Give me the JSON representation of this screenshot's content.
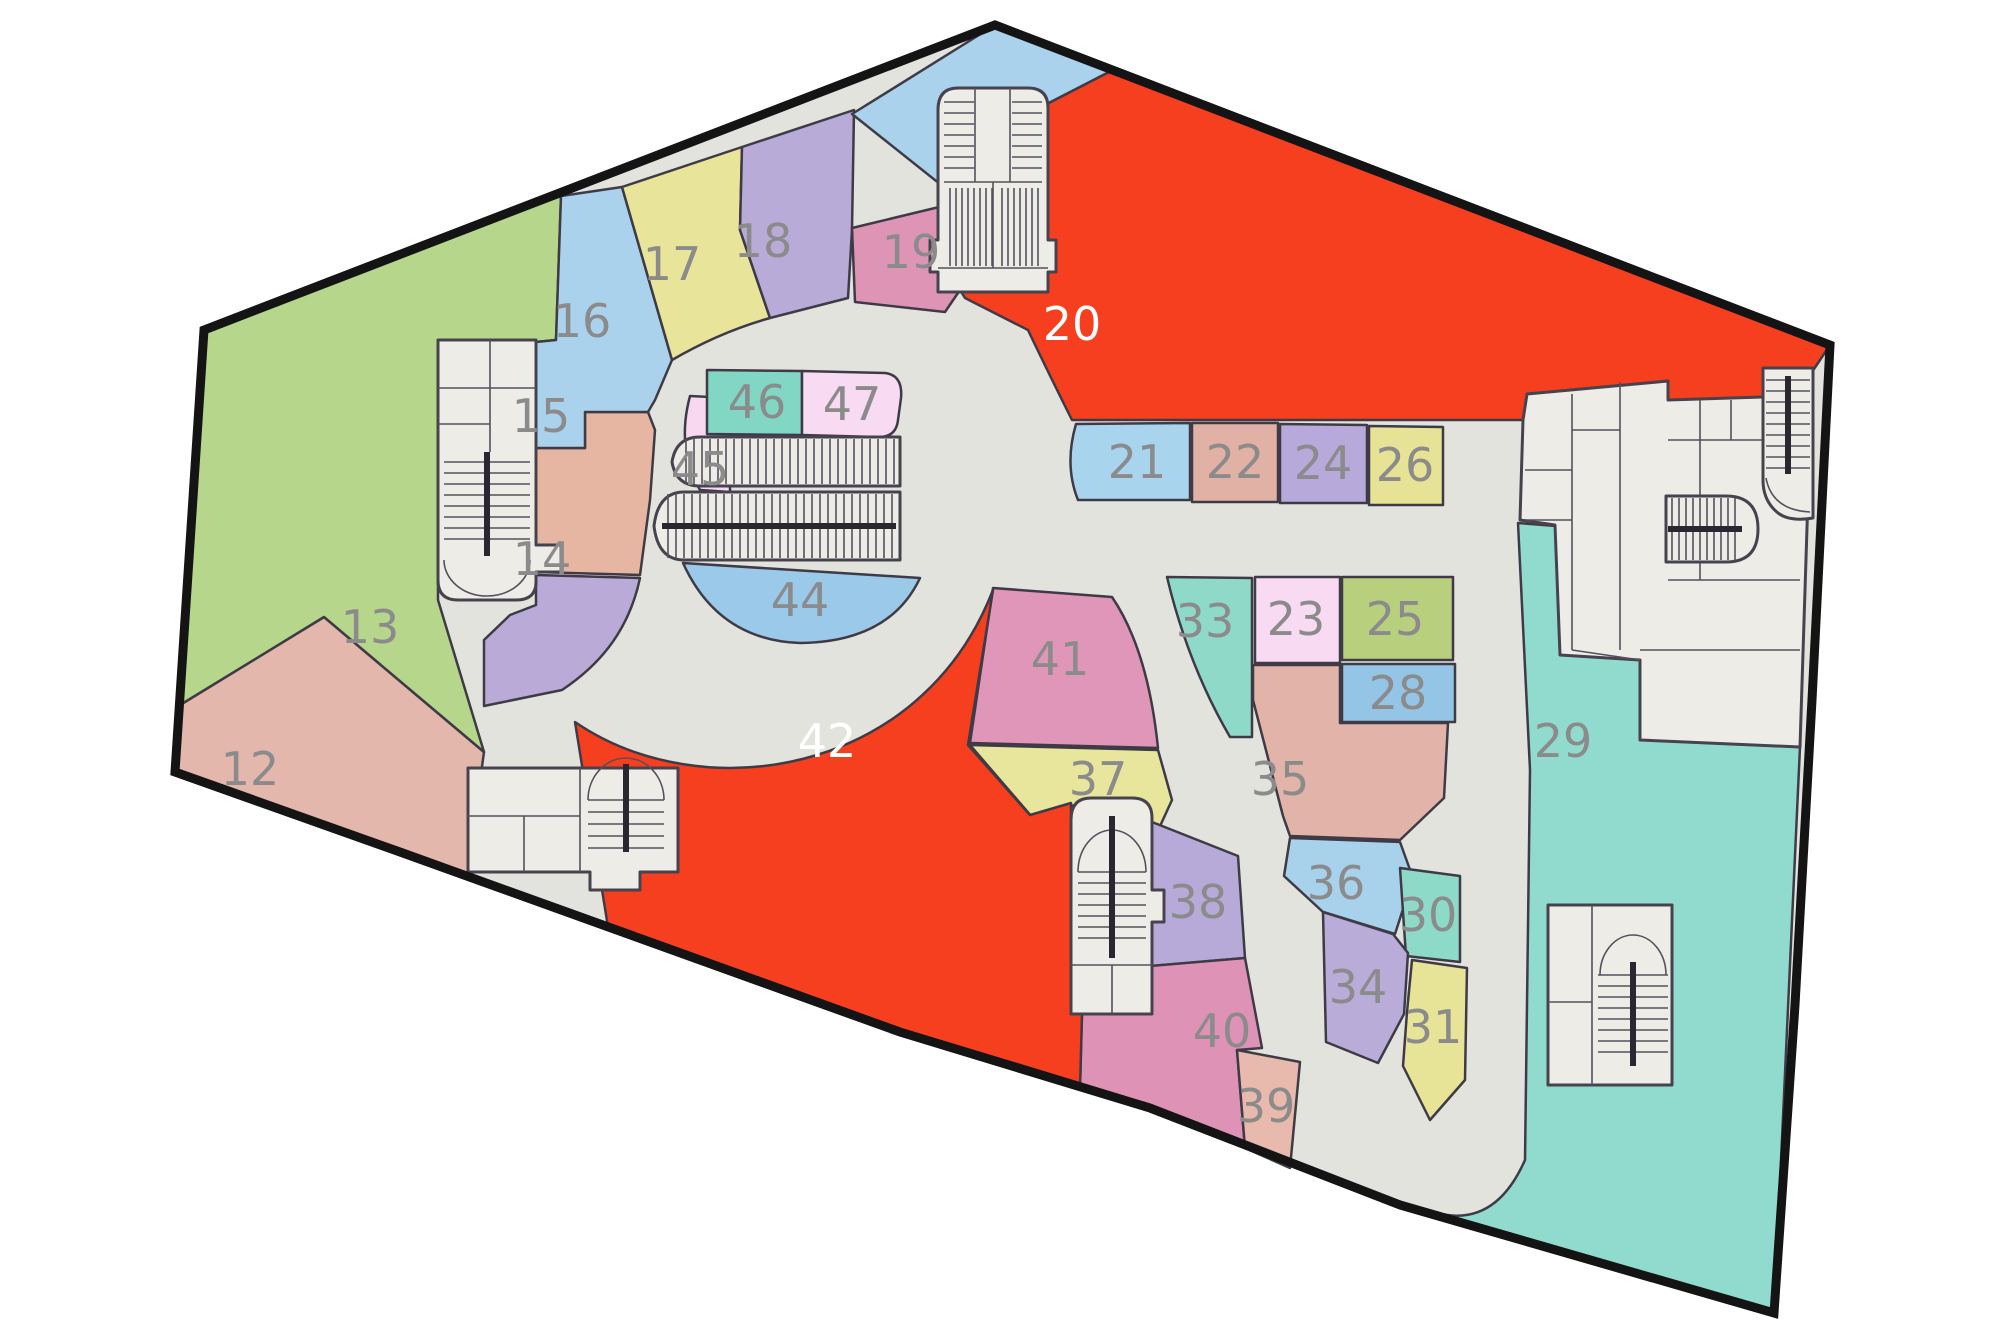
{
  "title": "Mall floor plan",
  "palette": {
    "floor": "#e3e3de",
    "module_fill": "#edece7",
    "module_stroke": "#47434e",
    "unit_stroke": "#3f3b46",
    "outline": "#141414",
    "label_gray": "#8b8b8b",
    "label_white": "#ffffff"
  },
  "outline_d": "M995,25 L1830,345 L1812,700 L1795,1005 L1774,1313 L1400,1205 L1150,1108 L900,1032 L650,942 L400,852 L175,772 L204,330 Z",
  "units": [
    {
      "id": "12",
      "label": "12",
      "color": "#e3b7ab",
      "lx": 250,
      "ly": 785,
      "light": false,
      "d": "M180,705 L324,617 L484,752 L467,876 L175,772 Z"
    },
    {
      "id": "13",
      "label": "13",
      "color": "#b6d78b",
      "lx": 370,
      "ly": 643,
      "light": false,
      "d": "M180,705 L204,330 L561,196 L556,340 L536,342 L438,342 L438,600 L484,752 L324,617 Z"
    },
    {
      "id": "14",
      "label": "14",
      "color": "#b9aad7",
      "lx": 542,
      "ly": 575,
      "light": false,
      "d": "M536,575 L640,578 C628,635 595,668 562,690 L484,706 L484,640 L510,615 L536,605 Z"
    },
    {
      "id": "15",
      "label": "15",
      "color": "#e6b6a2",
      "lx": 541,
      "ly": 432,
      "light": false,
      "d": "M536,448 L585,448 L585,412 L648,412 L655,430 L650,500 L640,575 L536,572 Z"
    },
    {
      "id": "16",
      "label": "16",
      "color": "#abd2ec",
      "lx": 582,
      "ly": 337,
      "light": false,
      "d": "M561,196 L622,187 L672,360 L655,400 L648,412 L585,412 L585,448 L536,448 L536,342 L556,340 Z"
    },
    {
      "id": "17",
      "label": "17",
      "color": "#e8e59b",
      "lx": 672,
      "ly": 280,
      "light": false,
      "d": "M622,187 L742,147 L740,230 L770,318 Q720,332 672,360 Z"
    },
    {
      "id": "18",
      "label": "18",
      "color": "#b9abd7",
      "lx": 763,
      "ly": 257,
      "light": false,
      "d": "M742,147 L854,110 L852,230 L848,298 L770,318 L740,230 Z"
    },
    {
      "id": "19",
      "label": "19",
      "color": "#de95b5",
      "lx": 911,
      "ly": 268,
      "light": false,
      "d": "M852,228 L960,202 L960,290 L945,312 L855,302 Z"
    },
    {
      "id": "u-apex",
      "label": "",
      "color": "#abd2ec",
      "lx": 0,
      "ly": 0,
      "light": false,
      "d": "M852,114 L995,25 L1113,70 L1045,105 L1045,290 L960,290 L960,200 Z"
    },
    {
      "id": "20",
      "label": "20",
      "color": "#f63f1f",
      "lx": 1072,
      "ly": 340,
      "light": true,
      "d": "M1045,105 L1113,70 L1830,345 L1812,372 L1765,370 L1763,397 L1668,400 L1668,381 L1527,394 L1523,420 L1072,420 Q1048,372 1028,330 L965,298 L960,290 L1045,290 Z"
    },
    {
      "id": "21",
      "label": "21",
      "color": "#a9d4ee",
      "lx": 1137,
      "ly": 478,
      "light": false,
      "d": "M1076,424 Q1064,465 1078,500 L1190,500 L1190,423 Z"
    },
    {
      "id": "22",
      "label": "22",
      "color": "#e2b1a6",
      "lx": 1235,
      "ly": 478,
      "light": false,
      "d": "M1192,423 L1278,423 L1278,502 L1192,502 Z"
    },
    {
      "id": "24",
      "label": "24",
      "color": "#b7a9d9",
      "lx": 1323,
      "ly": 479,
      "light": false,
      "d": "M1280,424 L1367,425 L1367,503 L1280,503 Z"
    },
    {
      "id": "26",
      "label": "26",
      "color": "#e7e396",
      "lx": 1405,
      "ly": 481,
      "light": false,
      "d": "M1369,426 L1443,427 L1443,505 L1369,505 Z"
    },
    {
      "id": "33",
      "label": "33",
      "color": "#8fd9c9",
      "lx": 1205,
      "ly": 637,
      "light": false,
      "d": "M1167,577 L1252,578 L1252,737 L1230,737 Q1188,665 1167,577 Z"
    },
    {
      "id": "23",
      "label": "23",
      "color": "#f8dbf3",
      "lx": 1296,
      "ly": 635,
      "light": false,
      "d": "M1255,577 L1340,577 L1340,663 L1255,663 Z"
    },
    {
      "id": "25",
      "label": "25",
      "color": "#b8d07e",
      "lx": 1395,
      "ly": 635,
      "light": false,
      "d": "M1342,577 L1453,577 L1453,660 L1342,660 Z"
    },
    {
      "id": "28",
      "label": "28",
      "color": "#94c4e6",
      "lx": 1398,
      "ly": 709,
      "light": false,
      "d": "M1342,664 L1455,664 L1455,722 L1342,722 Z"
    },
    {
      "id": "35",
      "label": "35",
      "color": "#e2b3a9",
      "lx": 1280,
      "ly": 795,
      "light": false,
      "d": "M1253,665 L1340,665 L1340,723 L1448,723 L1444,798 L1400,840 L1290,836 L1283,816 L1253,700 Z"
    },
    {
      "id": "36",
      "label": "36",
      "color": "#a8d1eb",
      "lx": 1336,
      "ly": 899,
      "light": false,
      "d": "M1290,838 L1400,842 L1413,878 L1395,934 L1323,912 L1284,876 Z"
    },
    {
      "id": "30",
      "label": "30",
      "color": "#8edac8",
      "lx": 1428,
      "ly": 931,
      "light": false,
      "d": "M1400,868 L1460,876 L1460,962 L1406,956 Z"
    },
    {
      "id": "34",
      "label": "34",
      "color": "#baacd9",
      "lx": 1358,
      "ly": 1003,
      "light": false,
      "d": "M1323,912 L1393,934 L1408,953 L1404,1014 L1378,1063 L1326,1042 Z"
    },
    {
      "id": "31",
      "label": "31",
      "color": "#e7e497",
      "lx": 1433,
      "ly": 1043,
      "light": false,
      "d": "M1412,960 L1467,968 L1465,1080 L1430,1120 L1403,1066 L1407,1012 Z"
    },
    {
      "id": "29",
      "label": "29",
      "color": "#90dbce",
      "lx": 1563,
      "ly": 757,
      "light": false,
      "d": "M1518,523 L1556,526 L1560,655 L1640,660 L1640,740 L1800,747 L1774,1313 L1437,1213 Q1495,1228 1525,1160 L1530,770 Z"
    },
    {
      "id": "41",
      "label": "41",
      "color": "#df96b8",
      "lx": 1060,
      "ly": 675,
      "light": false,
      "d": "M993,588 L1112,597 Q1148,650 1158,748 L970,743 Z"
    },
    {
      "id": "37",
      "label": "37",
      "color": "#e8e69c",
      "lx": 1098,
      "ly": 795,
      "light": false,
      "d": "M970,745 L1158,750 L1172,800 L1150,848 L1075,805 L1032,817 Z"
    },
    {
      "id": "38",
      "label": "38",
      "color": "#b8aad8",
      "lx": 1198,
      "ly": 918,
      "light": false,
      "d": "M1152,822 L1238,856 L1245,958 L1152,966 Z"
    },
    {
      "id": "40",
      "label": "40",
      "color": "#de93b6",
      "lx": 1222,
      "ly": 1047,
      "light": false,
      "d": "M1082,1014 L1150,1014 L1150,966 L1245,958 L1262,1048 L1237,1050 L1245,1148 L1150,1108 L1080,1088 Z"
    },
    {
      "id": "39",
      "label": "39",
      "color": "#e8b9ad",
      "lx": 1266,
      "ly": 1122,
      "light": false,
      "d": "M1237,1050 L1300,1062 L1290,1168 L1245,1148 Z"
    },
    {
      "id": "42",
      "label": "42",
      "color": "#f63f1f",
      "lx": 827,
      "ly": 757,
      "light": true,
      "d": "M575,722 C700,808 920,778 993,590 L968,745 L1030,815 L1071,803 L1071,1014 L1082,1014 L1080,1088 L900,1032 L650,942 L608,927 Z"
    },
    {
      "id": "44",
      "label": "44",
      "color": "#9bc9e9",
      "lx": 800,
      "ly": 616,
      "light": false,
      "d": "M683,563 L920,578 Q890,642 800,643 Q718,640 683,563 Z"
    },
    {
      "id": "45",
      "label": "45",
      "color": "#f7d8f0",
      "lx": 700,
      "ly": 485,
      "light": false,
      "d": "M690,396 L730,398 L730,492 L700,490 Q676,448 690,396 Z"
    },
    {
      "id": "46",
      "label": "46",
      "color": "#81d7c3",
      "lx": 757,
      "ly": 418,
      "light": false,
      "d": "M707,370 L802,371 L802,435 L707,434 Z"
    },
    {
      "id": "47",
      "label": "47",
      "color": "#f8dbf2",
      "lx": 852,
      "ly": 420,
      "light": false,
      "d": "M802,371 L885,373 Q903,375 901,398 L898,420 Q896,438 877,437 L802,435 Z"
    }
  ],
  "modules": [
    {
      "name": "stairwell-west",
      "base_d": "M438,340 L536,340 L536,545 L562,545 L562,572 L536,572 L536,582 Q536,600 516,600 L458,600 Q438,600 438,580 Z",
      "lines_d": "M490,340 L490,452 M438,388 L536,388 M438,424 L490,424 M444,560 A43,36 0 0 0 530,560",
      "rail_d": "M487,452 L487,556",
      "treads": {
        "dir": "h",
        "from": 462,
        "to": 540,
        "step": 11,
        "a": 444,
        "b": 530
      }
    },
    {
      "name": "stairwell-southwest",
      "base_d": "M468,768 L678,768 L678,872 L640,872 L640,890 L590,890 L590,872 L468,872 Z",
      "lines_d": "M580,768 L580,872 M468,816 L580,816 M524,816 L524,872 M588,800 A38,42 0 1 1 664,800",
      "rail_d": "M626,764 L626,852",
      "treads": {
        "dir": "h",
        "from": 800,
        "to": 848,
        "step": 12,
        "a": 588,
        "b": 664
      }
    },
    {
      "name": "stairwell-top",
      "base_d": "M938,110 Q938,88 958,88 L1028,88 Q1048,88 1048,108 L1048,240 L1056,240 L1056,272 L1048,272 L1048,292 L938,292 L938,272 L930,272 L930,240 L938,240 Z",
      "lines_d": "M975,88 L975,182 M1010,88 L1010,182 M944,182 L1042,182 M993,182 L993,268 M938,268 L1048,268",
      "rail_d": "",
      "treads": {
        "dir": "h",
        "from": 102,
        "to": 178,
        "step": 11,
        "a": 944,
        "b": 974
      },
      "treads2": {
        "dir": "h",
        "from": 102,
        "to": 178,
        "step": 11,
        "a": 1012,
        "b": 1042
      },
      "stripes": {
        "dir": "v",
        "from": 950,
        "to": 992,
        "step": 6,
        "a": 188,
        "b": 266
      },
      "stripes2": {
        "dir": "v",
        "from": 1002,
        "to": 1040,
        "step": 6,
        "a": 188,
        "b": 266
      }
    },
    {
      "name": "escalator-center-upper",
      "base_d": "M900,437 L700,437 Q676,437 672,462 Q676,486 700,486 L900,486 Z",
      "lines_d": "",
      "rail_d": "",
      "stripes": {
        "dir": "v",
        "from": 686,
        "to": 894,
        "step": 8,
        "a": 439,
        "b": 484
      }
    },
    {
      "name": "escalator-center-lower",
      "base_d": "M900,492 L684,492 Q658,492 654,526 Q658,560 684,560 L900,560 Z",
      "lines_d": "",
      "rail_d": "M662,526 L896,526",
      "stripes": {
        "dir": "v",
        "from": 668,
        "to": 894,
        "step": 8,
        "a": 494,
        "b": 558
      }
    },
    {
      "name": "service-rooms-northeast",
      "base_d": "M1527,394 L1668,381 L1668,400 L1763,397 L1763,368 L1812,371 L1800,747 L1640,740 L1640,660 L1560,655 L1555,525 L1520,520 L1523,420 Z",
      "lines_d": "M1572,394 L1572,650 M1525,470 L1572,470 M1525,520 L1572,520 M1620,382 L1620,650 M1572,430 L1620,430 M1668,440 L1762,440 M1700,400 L1700,580 M1668,580 L1800,580 M1731,400 L1731,440 M1640,650 L1800,650 M1572,650 L1640,660",
      "rail_d": ""
    },
    {
      "name": "stairwell-right",
      "base_d": "M1763,368 L1813,368 L1813,518 Q1790,522 1778,513 Q1763,501 1763,480 Z",
      "lines_d": "M1766,478 Q1772,510 1810,512",
      "rail_d": "M1788,376 L1788,474",
      "treads": {
        "dir": "h",
        "from": 380,
        "to": 468,
        "step": 11,
        "a": 1766,
        "b": 1810
      }
    },
    {
      "name": "escalator-right",
      "base_d": "M1666,496 L1726,496 Q1758,496 1758,529 Q1758,562 1726,562 L1666,562 Z",
      "lines_d": "",
      "rail_d": "M1668,529 L1742,529",
      "stripes": {
        "dir": "v",
        "from": 1672,
        "to": 1738,
        "step": 7,
        "a": 498,
        "b": 560
      }
    },
    {
      "name": "stairwell-south",
      "base_d": "M1071,820 Q1071,798 1091,798 L1132,798 Q1152,798 1152,818 L1152,890 L1164,890 L1164,922 L1152,922 L1152,1014 L1071,1014 Z",
      "lines_d": "M1078,872 A34,42 0 1 1 1146,872 M1071,965 L1152,965 M1112,965 L1112,1014",
      "rail_d": "M1112,816 L1112,958",
      "treads": {
        "dir": "h",
        "from": 872,
        "to": 948,
        "step": 11,
        "a": 1078,
        "b": 1146
      }
    },
    {
      "name": "stairwell-29",
      "base_d": "M1548,905 L1672,905 L1672,1085 L1548,1085 Z",
      "lines_d": "M1592,905 L1592,1085 M1548,1002 L1592,1002 M1600,975 A33,40 0 1 1 1666,975",
      "rail_d": "M1633,962 L1633,1066",
      "treads": {
        "dir": "h",
        "from": 975,
        "to": 1052,
        "step": 11,
        "a": 1598,
        "b": 1668
      }
    }
  ]
}
